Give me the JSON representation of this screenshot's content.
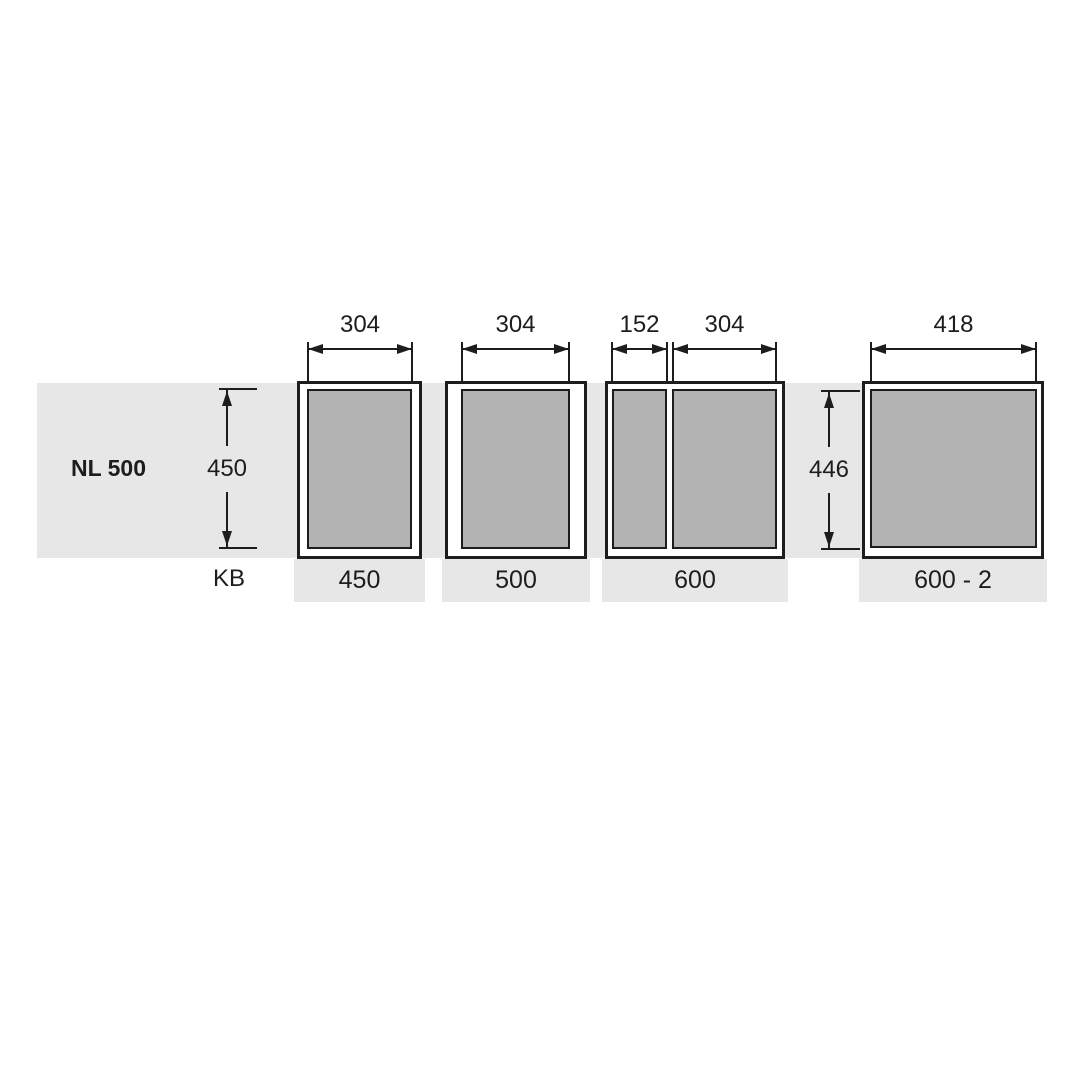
{
  "labels": {
    "nl": "NL 500",
    "kb": "KB"
  },
  "top_dims": [
    {
      "label": "304"
    },
    {
      "label": "304"
    },
    {
      "label": "152"
    },
    {
      "label": "304"
    },
    {
      "label": "418"
    }
  ],
  "side_dims": [
    {
      "label": "450"
    },
    {
      "label": "446"
    }
  ],
  "kb_labels": [
    {
      "label": "450"
    },
    {
      "label": "500"
    },
    {
      "label": "600"
    },
    {
      "label": "600 - 2"
    }
  ],
  "colors": {
    "row_band": "#e7e7e7",
    "basket_fill": "#b3b3b3",
    "line": "#1d1d1d",
    "background": "#ffffff"
  }
}
